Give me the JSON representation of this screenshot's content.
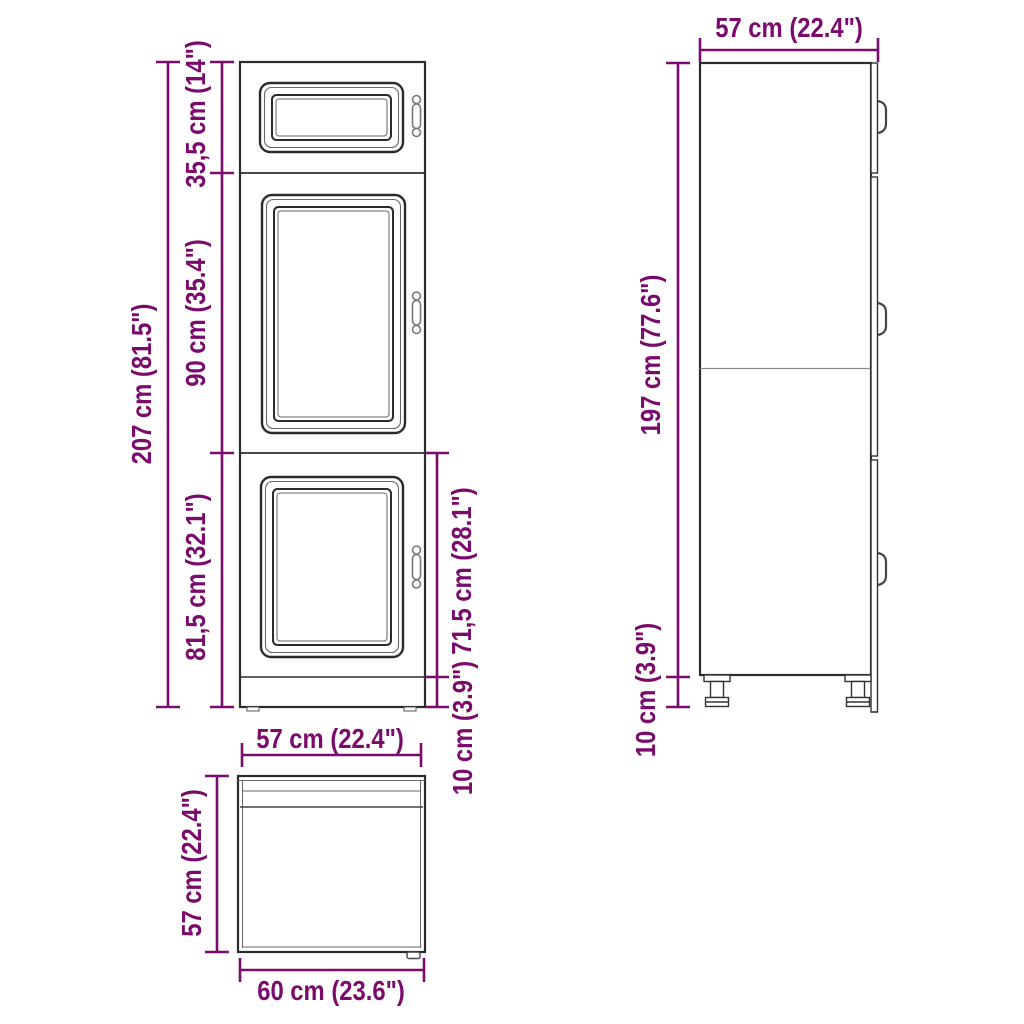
{
  "accent_color": "#7a0a6c",
  "line_color": "#2b2b2b",
  "background_color": "#ffffff",
  "diagram_title": "kitchen-tall-cabinet-dimension-diagram",
  "views": {
    "front": {
      "name": "front view",
      "dims": {
        "total_height": "207 cm (81.5\")",
        "top_section_height": "35,5 cm (14\")",
        "middle_section_height": "90 cm (35.4\")",
        "bottom_section_height": "81,5 cm (32.1\")",
        "bottom_door_height": "71,5 cm (28.1\")",
        "plinth_height": "10 cm (3.9\")",
        "width": "57 cm (22.4\")"
      }
    },
    "top": {
      "name": "top view",
      "dims": {
        "depth": "57 cm (22.4\")",
        "total_depth": "60 cm (23.6\")"
      }
    },
    "side": {
      "name": "side view",
      "dims": {
        "depth": "57 cm (22.4\")",
        "body_height": "197 cm (77.6\")",
        "leg_height": "10 cm (3.9\")"
      }
    }
  }
}
